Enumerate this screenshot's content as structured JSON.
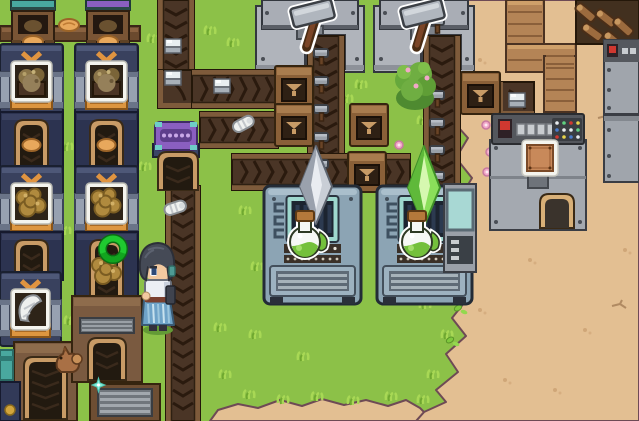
{
  "app": {
    "name": "pixel-factory-automation-game",
    "scene_label": "factory overworld"
  },
  "palette": {
    "grass": "#8cc148",
    "grass_light": "#a8d855",
    "grass_dark": "#6fa830",
    "sand": "#e3bf92",
    "sand_edge": "#6e4a55",
    "sand_speckle": "#cfa678",
    "belt_surface": "#4a3526",
    "belt_rail": "#7e5b3b",
    "belt_chevron": "#2a1a0e",
    "navy_machine": "#39415e",
    "navy_base": "#2c3350",
    "machine_orange": "#e09440",
    "press_grey": "#b0b4bb",
    "flask_machine": "#8ca4b4",
    "screen_teal": "#9ed8ce",
    "crystal_grey": "#c9ced6",
    "crystal_green": "#8adf5a",
    "wood": "#7a5a40",
    "wood_light": "#b48456",
    "arch_tan": "#c89b66",
    "purple_device": "#8a5fc0",
    "console_grey": "#a4a9b0",
    "ring_green": "#1fc930",
    "potion_green": "#74c03c",
    "hair": "#454a56",
    "skin": "#f2c9a0",
    "skirt_blue": "#6fa3c8"
  },
  "hud": {
    "visible_text": []
  },
  "scene": {
    "width": 639,
    "height": 421,
    "grass": "#8cc148",
    "entities": [
      {
        "t": "sand",
        "n": "sand-terrain",
        "x": 0,
        "y": 0,
        "w": 639,
        "h": 421,
        "o": {
          "main": "445,0 452,18 442,38 456,58 444,80 462,98 450,118 468,138 456,158 472,178 460,198 476,218 458,238 472,258 454,278 468,298 452,318 466,336 446,354 458,372 436,390 446,402 424,412 416,421 639,421 639,0",
          "strip": "210,421 218,410 238,404 258,408 280,400 302,406 322,399 344,405 366,400 388,406 406,400 420,408 424,412 416,421",
          "speckles": [
            [
              480,
              60
            ],
            [
              510,
              150
            ],
            [
              545,
              95
            ],
            [
              575,
              210
            ],
            [
              610,
              160
            ],
            [
              530,
              260
            ],
            [
              585,
              330
            ],
            [
              505,
              380
            ],
            [
              625,
              250
            ],
            [
              555,
              390
            ],
            [
              480,
              310
            ],
            [
              620,
              55
            ],
            [
              590,
              25
            ]
          ],
          "cracks": [
            [
              612,
              300
            ],
            [
              558,
              48
            ],
            [
              598,
              112
            ]
          ]
        }
      },
      {
        "t": "tufts",
        "n": "grass-tufts",
        "x": 0,
        "y": 0,
        "w": 639,
        "h": 421,
        "o": {
          "pts": [
            [
              62,
              142
            ],
            [
              148,
              34
            ],
            [
              205,
              26
            ],
            [
              240,
              206
            ],
            [
              215,
              323
            ],
            [
              252,
              262
            ],
            [
              298,
              352
            ],
            [
              342,
              94
            ],
            [
              412,
              240
            ],
            [
              418,
              116
            ],
            [
              244,
              390
            ],
            [
              278,
              395
            ],
            [
              312,
              392
            ],
            [
              348,
              396
            ],
            [
              386,
              392
            ],
            [
              60,
              226
            ],
            [
              140,
              162
            ],
            [
              228,
              38
            ],
            [
              356,
              80
            ],
            [
              395,
              200
            ],
            [
              420,
              300
            ],
            [
              430,
              260
            ],
            [
              65,
              316
            ],
            [
              440,
              30
            ],
            [
              436,
              90
            ],
            [
              448,
              170
            ],
            [
              446,
              250
            ],
            [
              442,
              330
            ],
            [
              428,
              370
            ],
            [
              418,
              395
            ],
            [
              250,
              330
            ],
            [
              220,
              370
            ]
          ]
        }
      },
      {
        "t": "leaves",
        "n": "fallen-leaves",
        "x": 0,
        "y": 0,
        "w": 639,
        "h": 421,
        "o": {
          "pts": [
            [
              424,
              70
            ],
            [
              435,
              88
            ],
            [
              444,
              102
            ],
            [
              452,
              222
            ],
            [
              458,
              308
            ],
            [
              430,
              115
            ],
            [
              450,
              340
            ]
          ]
        }
      },
      {
        "t": "pinks",
        "n": "pink-flowers",
        "x": 0,
        "y": 0,
        "w": 639,
        "h": 421,
        "o": {
          "pts": [
            [
              399,
              145
            ],
            [
              380,
              30
            ],
            [
              486,
              125
            ],
            [
              490,
              152
            ],
            [
              487,
              172
            ]
          ]
        }
      },
      {
        "t": "press",
        "n": "hammer-press-machine",
        "x": 256,
        "y": 0,
        "w": 108,
        "h": 72,
        "o": {
          "slot": 48
        }
      },
      {
        "t": "press",
        "n": "hammer-press-machine",
        "x": 374,
        "y": 0,
        "w": 100,
        "h": 72,
        "o": {
          "slot": 46
        }
      },
      {
        "t": "beltV",
        "n": "conveyor-belt-vertical",
        "x": 158,
        "y": 0,
        "w": 36,
        "h": 74
      },
      {
        "t": "beltC",
        "n": "conveyor-belt-corner",
        "x": 158,
        "y": 70,
        "w": 36,
        "h": 38
      },
      {
        "t": "beltH",
        "n": "conveyor-belt-horizontal",
        "x": 192,
        "y": 70,
        "w": 86,
        "h": 38
      },
      {
        "t": "beltH",
        "n": "conveyor-belt-horizontal",
        "x": 200,
        "y": 112,
        "w": 78,
        "h": 36
      },
      {
        "t": "beltV",
        "n": "hammer-feed-belt",
        "x": 308,
        "y": 36,
        "w": 36,
        "h": 154
      },
      {
        "t": "beltV",
        "n": "hammer-feed-belt",
        "x": 424,
        "y": 36,
        "w": 36,
        "h": 154
      },
      {
        "t": "beltH",
        "n": "conveyor-belt-horizontal",
        "x": 232,
        "y": 154,
        "w": 178,
        "h": 36
      },
      {
        "t": "beltV",
        "n": "conveyor-belt-vertical",
        "x": 166,
        "y": 186,
        "w": 34,
        "h": 235
      },
      {
        "t": "beltC",
        "n": "conveyor-belt-corner",
        "x": 498,
        "y": 82,
        "w": 36,
        "h": 34
      },
      {
        "t": "cube",
        "n": "white-cube-item",
        "x": 164,
        "y": 38,
        "w": 19,
        "h": 17
      },
      {
        "t": "cube",
        "n": "white-cube-item",
        "x": 164,
        "y": 70,
        "w": 19,
        "h": 17
      },
      {
        "t": "cube",
        "n": "white-cube-item",
        "x": 213,
        "y": 78,
        "w": 19,
        "h": 17
      },
      {
        "t": "cube",
        "n": "white-cube-item",
        "x": 508,
        "y": 92,
        "w": 19,
        "h": 17
      },
      {
        "t": "shell",
        "n": "white-shell-item",
        "x": 232,
        "y": 114,
        "w": 24,
        "h": 18,
        "o": {
          "r": -28
        }
      },
      {
        "t": "shell",
        "n": "white-shell-item",
        "x": 164,
        "y": 198,
        "w": 24,
        "h": 18,
        "o": {
          "r": -18
        }
      },
      {
        "t": "hammerS",
        "n": "hammer-item",
        "x": 312,
        "y": 46,
        "w": 20,
        "h": 20
      },
      {
        "t": "hammerS",
        "n": "hammer-item",
        "x": 312,
        "y": 74,
        "w": 20,
        "h": 20
      },
      {
        "t": "hammerS",
        "n": "hammer-item",
        "x": 312,
        "y": 102,
        "w": 20,
        "h": 20
      },
      {
        "t": "hammerS",
        "n": "hammer-item",
        "x": 312,
        "y": 130,
        "w": 20,
        "h": 20
      },
      {
        "t": "hammerS",
        "n": "hammer-item",
        "x": 312,
        "y": 157,
        "w": 20,
        "h": 20
      },
      {
        "t": "hammerS",
        "n": "hammer-item",
        "x": 428,
        "y": 14,
        "w": 20,
        "h": 20
      },
      {
        "t": "hammerS",
        "n": "hammer-item",
        "x": 428,
        "y": 88,
        "w": 20,
        "h": 20
      },
      {
        "t": "hammerS",
        "n": "hammer-item",
        "x": 428,
        "y": 116,
        "w": 20,
        "h": 20
      },
      {
        "t": "hammerS",
        "n": "hammer-item",
        "x": 428,
        "y": 143,
        "w": 20,
        "h": 20
      },
      {
        "t": "hammerS",
        "n": "hammer-item",
        "x": 428,
        "y": 169,
        "w": 20,
        "h": 20
      },
      {
        "t": "box",
        "n": "loader-hopper-box",
        "x": 275,
        "y": 66,
        "w": 38,
        "h": 42
      },
      {
        "t": "box",
        "n": "loader-hopper-box",
        "x": 275,
        "y": 104,
        "w": 38,
        "h": 42
      },
      {
        "t": "box",
        "n": "loader-hopper-box",
        "x": 350,
        "y": 104,
        "w": 38,
        "h": 42
      },
      {
        "t": "box",
        "n": "loader-hopper-box",
        "x": 348,
        "y": 152,
        "w": 38,
        "h": 40
      },
      {
        "t": "box",
        "n": "loader-hopper-box",
        "x": 461,
        "y": 72,
        "w": 39,
        "h": 42
      },
      {
        "t": "purpleDev",
        "n": "belt-filter-device",
        "x": 151,
        "y": 120,
        "w": 50,
        "h": 38
      },
      {
        "t": "smallArch",
        "n": "belt-tunnel-arch",
        "x": 156,
        "y": 150,
        "w": 44,
        "h": 42
      },
      {
        "t": "beam",
        "n": "wooden-beam",
        "x": 0,
        "y": 26,
        "w": 140,
        "h": 15
      },
      {
        "t": "bread",
        "n": "dough-item",
        "x": 58,
        "y": 18,
        "w": 22,
        "h": 14
      },
      {
        "t": "hopper",
        "n": "input-hopper",
        "x": 8,
        "y": 0,
        "w": 50,
        "h": 48,
        "o": {
          "top": "#49a89f"
        }
      },
      {
        "t": "hopper",
        "n": "input-hopper",
        "x": 83,
        "y": 0,
        "w": 50,
        "h": 48,
        "o": {
          "top": "#8a5fc0"
        }
      },
      {
        "t": "navy",
        "n": "collector-machine",
        "x": 0,
        "y": 44,
        "w": 63,
        "h": 72,
        "o": {
          "item": "sack"
        }
      },
      {
        "t": "navy",
        "n": "collector-machine",
        "x": 75,
        "y": 44,
        "w": 63,
        "h": 72,
        "o": {
          "item": "sack"
        }
      },
      {
        "t": "base",
        "n": "collector-output-base",
        "x": 0,
        "y": 112,
        "w": 63,
        "h": 58,
        "o": {
          "bread": true
        }
      },
      {
        "t": "base",
        "n": "collector-output-base",
        "x": 75,
        "y": 112,
        "w": 63,
        "h": 58,
        "o": {
          "bread": true
        }
      },
      {
        "t": "navy",
        "n": "collector-machine",
        "x": 0,
        "y": 166,
        "w": 63,
        "h": 70,
        "o": {
          "item": "fiber"
        }
      },
      {
        "t": "navy",
        "n": "collector-machine",
        "x": 75,
        "y": 166,
        "w": 63,
        "h": 70,
        "o": {
          "item": "fiber"
        }
      },
      {
        "t": "base",
        "n": "collector-output-base",
        "x": 0,
        "y": 232,
        "w": 63,
        "h": 48
      },
      {
        "t": "base",
        "n": "collector-output-base",
        "x": 75,
        "y": 232,
        "w": 63,
        "h": 68
      },
      {
        "t": "fiberLoose",
        "n": "fiber-item",
        "x": 92,
        "y": 256,
        "w": 30,
        "h": 30
      },
      {
        "t": "navy",
        "n": "collector-machine",
        "x": 0,
        "y": 272,
        "w": 61,
        "h": 74,
        "o": {
          "item": "chisel"
        }
      },
      {
        "t": "archA",
        "n": "conveyor-tunnel-building",
        "x": 14,
        "y": 342,
        "w": 63,
        "h": 79
      },
      {
        "t": "bldgB",
        "n": "conveyor-tunnel-building",
        "x": 72,
        "y": 296,
        "w": 70,
        "h": 86
      },
      {
        "t": "slatB",
        "n": "vent-crate",
        "x": 90,
        "y": 384,
        "w": 70,
        "h": 37
      },
      {
        "t": "tealFrag",
        "n": "machine-fragment",
        "x": 0,
        "y": 350,
        "w": 13,
        "h": 30
      },
      {
        "t": "navyFrag",
        "n": "machine-fragment",
        "x": 0,
        "y": 382,
        "w": 20,
        "h": 39
      },
      {
        "t": "flask",
        "n": "potion-brewer-machine",
        "x": 264,
        "y": 186,
        "w": 97,
        "h": 118
      },
      {
        "t": "flask",
        "n": "potion-brewer-machine",
        "x": 377,
        "y": 186,
        "w": 95,
        "h": 118
      },
      {
        "t": "crystal",
        "n": "grey-crystal",
        "x": 296,
        "y": 146,
        "w": 40,
        "h": 78,
        "o": {
          "c": [
            "#c9ced6",
            "#9aa1ad",
            "#e9ecf1",
            "#5e6570"
          ]
        }
      },
      {
        "t": "crystal",
        "n": "green-crystal",
        "x": 404,
        "y": 146,
        "w": 40,
        "h": 80,
        "o": {
          "c": [
            "#8adf5a",
            "#5fb93a",
            "#d6f8b0",
            "#3f8f28"
          ]
        }
      },
      {
        "t": "flaskIcon",
        "n": "potion-flask-icon",
        "x": 286,
        "y": 210,
        "w": 46,
        "h": 50
      },
      {
        "t": "flaskIcon",
        "n": "potion-flask-icon",
        "x": 398,
        "y": 210,
        "w": 46,
        "h": 50
      },
      {
        "t": "hammerIcon",
        "n": "hammer-recipe-icon",
        "x": 288,
        "y": 0,
        "w": 58,
        "h": 46
      },
      {
        "t": "hammerIcon",
        "n": "hammer-recipe-icon",
        "x": 398,
        "y": 0,
        "w": 58,
        "h": 46
      },
      {
        "t": "stairs",
        "n": "wooden-walkway",
        "x": 506,
        "y": 0,
        "w": 70,
        "h": 112
      },
      {
        "t": "logBelt",
        "n": "log-conveyor",
        "x": 576,
        "y": 0,
        "w": 63,
        "h": 44
      },
      {
        "t": "console",
        "n": "fabricator-console",
        "x": 490,
        "y": 114,
        "w": 96,
        "h": 116
      },
      {
        "t": "plateIcon",
        "n": "copper-plate-icon",
        "x": 522,
        "y": 140,
        "w": 36,
        "h": 36
      },
      {
        "t": "consoleFrag",
        "n": "console-side-machine",
        "x": 444,
        "y": 184,
        "w": 32,
        "h": 88
      },
      {
        "t": "rightM1",
        "n": "edge-machine",
        "x": 604,
        "y": 40,
        "w": 35,
        "h": 74
      },
      {
        "t": "rightM2",
        "n": "edge-machine",
        "x": 604,
        "y": 116,
        "w": 35,
        "h": 66
      },
      {
        "t": "bush",
        "n": "flower-bush",
        "x": 394,
        "y": 60,
        "w": 42,
        "h": 48
      },
      {
        "t": "creature",
        "n": "small-critter",
        "x": 52,
        "y": 344,
        "w": 30,
        "h": 34
      },
      {
        "t": "ring",
        "n": "selection-ring",
        "x": 98,
        "y": 234,
        "w": 30,
        "h": 30
      },
      {
        "t": "character",
        "n": "player-character",
        "x": 136,
        "y": 240,
        "w": 42,
        "h": 96
      },
      {
        "t": "sparkle",
        "n": "sparkle-effect",
        "x": 92,
        "y": 378,
        "w": 13,
        "h": 14
      }
    ]
  }
}
